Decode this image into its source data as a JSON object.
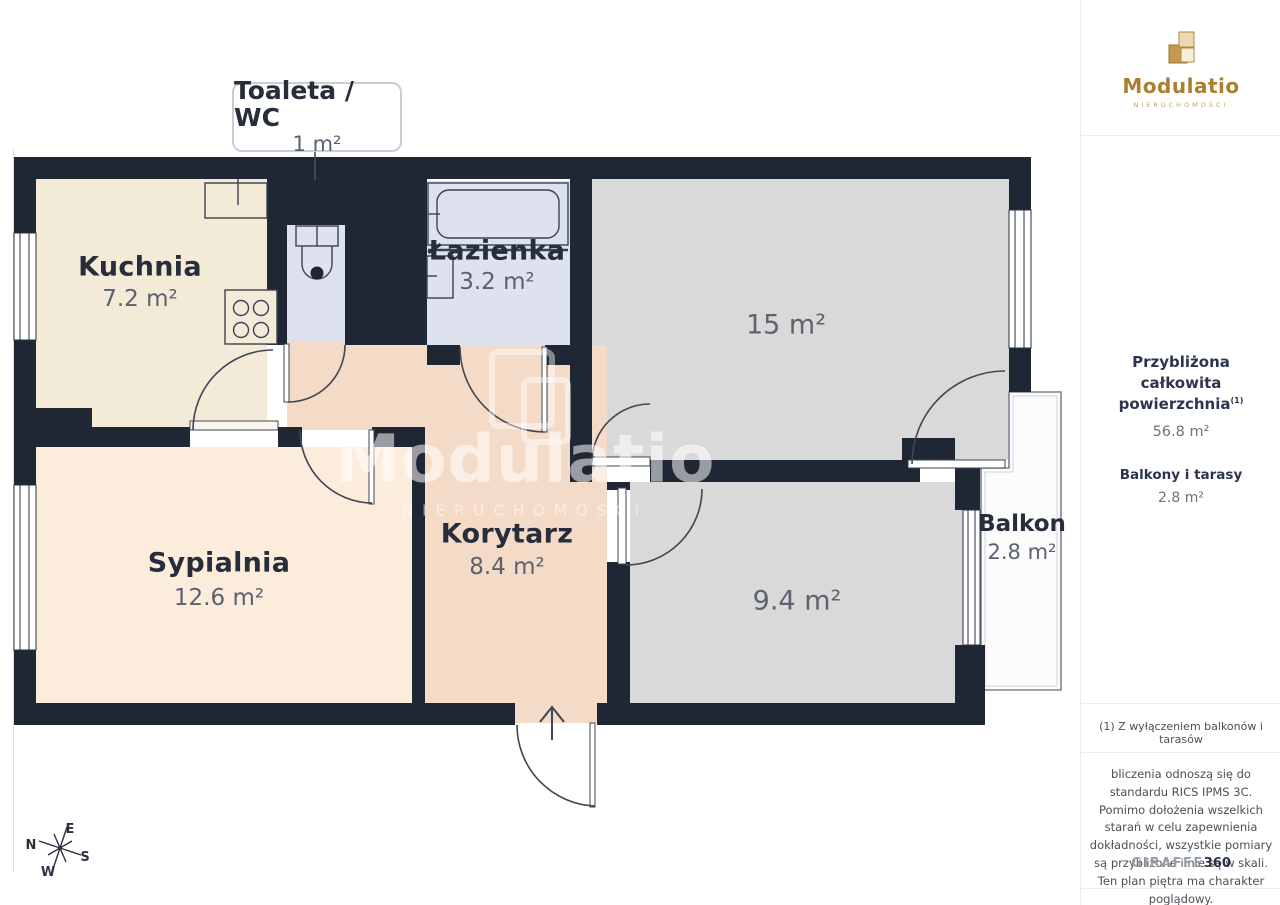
{
  "plan": {
    "callout": {
      "title": "Toaleta / WC",
      "area": "1 m²"
    },
    "rooms": {
      "kuchnia": {
        "name": "Kuchnia",
        "area": "7.2 m²"
      },
      "lazienka": {
        "name": "Łazienka",
        "area": "3.2 m²"
      },
      "room15": {
        "area": "15 m²"
      },
      "sypialnia": {
        "name": "Sypialnia",
        "area": "12.6 m²"
      },
      "korytarz": {
        "name": "Korytarz",
        "area": "8.4 m²"
      },
      "room94": {
        "area": "9.4 m²"
      },
      "balkon": {
        "name": "Balkon",
        "area": "2.8 m²"
      }
    },
    "compass": {
      "n": "N",
      "e": "E",
      "s": "S",
      "w": "W"
    },
    "watermark": {
      "title": "Modulatio",
      "subtitle": "NIERUCHOMOŚCI"
    },
    "colors": {
      "wall": "#1e2733",
      "kitchen_fill": "#f3ead7",
      "bedroom_fill": "#fcecdc",
      "corridor_fill": "#f4dbc8",
      "bathroom_fill": "#dde2ee",
      "gray_room_fill": "#d9d9d9",
      "balcony_fill": "#fcfcfc",
      "brand_gold": "#ab7f2e"
    }
  },
  "sidebar": {
    "logo": {
      "title": "Modulatio",
      "subtitle": "NIERUCHOMOŚCI"
    },
    "summary": {
      "heading_line1": "Przybliżona całkowita",
      "heading_line2": "powierzchnia",
      "heading_sup": "(1)",
      "total": "56.8 m²",
      "balconies_label": "Balkony i tarasy",
      "balconies_value": "2.8 m²"
    },
    "footnote": "(1) Z wyłączeniem balkonów i tarasów",
    "disclaimer": "bliczenia odnoszą się do standardu RICS IPMS 3C. Pomimo dołożenia wszelkich starań w celu zapewnienia dokładności, wszystkie pomiary są przybliżone i nie są w skali. Ten plan piętra ma charakter poglądowy.",
    "brand": {
      "giraffe": "GIRAFFE",
      "n360": "360"
    }
  }
}
